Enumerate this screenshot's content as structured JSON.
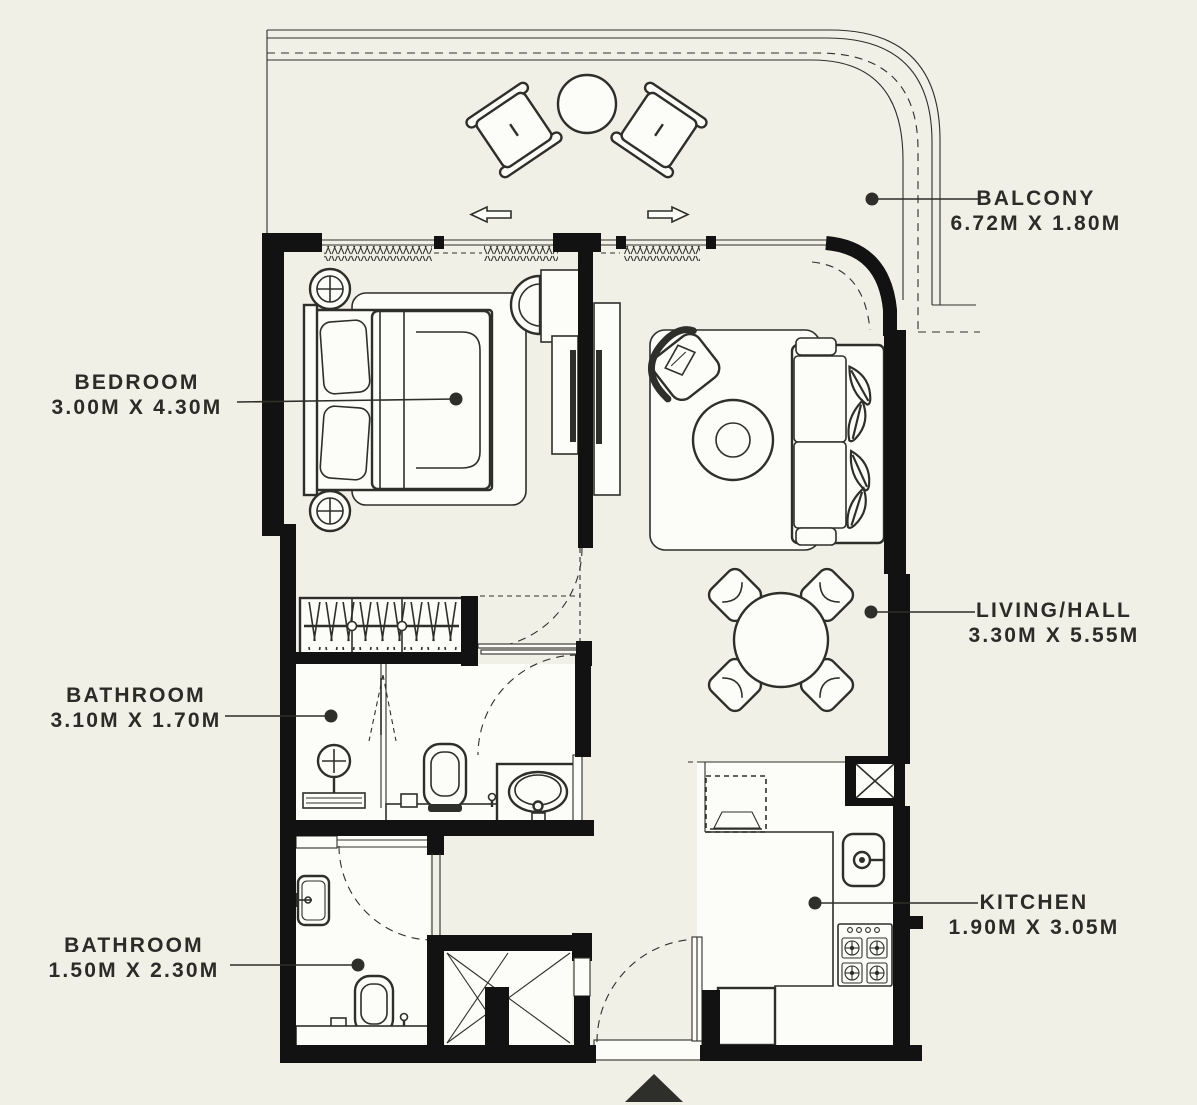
{
  "plan_title": "Apartment floor plan",
  "rooms": {
    "bedroom": {
      "name": "BEDROOM",
      "dims": "3.00M X 4.30M"
    },
    "bathroom_top": {
      "name": "BATHROOM",
      "dims": "3.10M X 1.70M"
    },
    "bathroom_bottom": {
      "name": "BATHROOM",
      "dims": "1.50M X 2.30M"
    },
    "balcony": {
      "name": "BALCONY",
      "dims": "6.72M X 1.80M"
    },
    "living": {
      "name": "LIVING/HALL",
      "dims": "3.30M X 5.55M"
    },
    "kitchen": {
      "name": "KITCHEN",
      "dims": "1.90M X 3.05M"
    }
  },
  "furniture_items": [
    "balcony lounge chairs",
    "balcony round table",
    "double bed",
    "bedside lamp tables",
    "desk and chair",
    "tv wall units",
    "wardrobe with hangers",
    "shower",
    "toilets",
    "vanity washbasin",
    "wall washbasin",
    "sofa with cushions",
    "armchair",
    "round coffee table",
    "dining table with four chairs",
    "kitchen sink",
    "four burner hob",
    "refrigerator",
    "washing machine",
    "entry door",
    "duct shafts"
  ],
  "colors": {
    "background": "#f1f0e7",
    "wall": "#121212",
    "line": "#2e2e2a",
    "text": "#2b2b27",
    "furniture_fill": "#fcfcf9"
  }
}
